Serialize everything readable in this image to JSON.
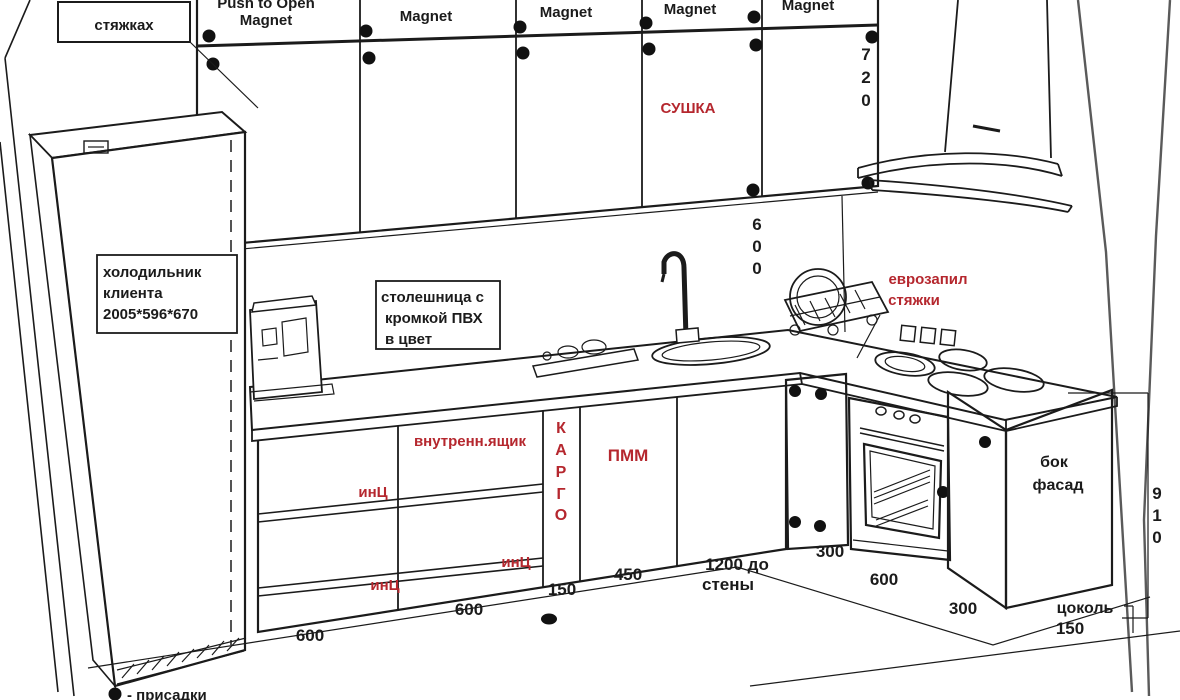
{
  "colors": {
    "ink": "#1b1b1b",
    "red": "#b5272e",
    "background": "#ffffff"
  },
  "wall_cabinets": {
    "doors": [
      {
        "top": "Push to Open",
        "label": "Magnet"
      },
      {
        "label": "Magnet"
      },
      {
        "label": "Magnet"
      },
      {
        "label": "Magnet"
      },
      {
        "label": "Magnet"
      }
    ],
    "dryer_label": "СУШКА",
    "height_digits": [
      "7",
      "2",
      "0"
    ]
  },
  "notes": {
    "ties": "стяжках",
    "fridge": {
      "lines": [
        "холодильник",
        "клиента",
        "2005*596*670"
      ]
    },
    "countertop": {
      "lines": [
        "столешница с",
        "кромкой ПВХ",
        "в цвет"
      ]
    },
    "euro_cut": {
      "lines": [
        "еврозапил",
        "стяжки"
      ]
    },
    "side_facade": {
      "lines": [
        "бок",
        "фасад"
      ]
    },
    "legend_text": "- присадки"
  },
  "base_cabinets": {
    "inner_drawer": "внутренн.ящик",
    "cargo_chars": [
      "К",
      "А",
      "Р",
      "Г",
      "О"
    ],
    "dishwasher": "ПММ",
    "hinge_a": "инЦ",
    "hinge_b": "инЦ",
    "hinge_c": "инЦ"
  },
  "dimensions": {
    "wall_gap_digits": [
      "6",
      "0",
      "0"
    ],
    "base_height_digits": [
      "9",
      "1",
      "0"
    ],
    "w600_left": "600",
    "w600_mid": "600",
    "w150_cargo": "150",
    "w450_pmm": "450",
    "to_wall": {
      "lines": [
        "1200 до",
        "стены"
      ]
    },
    "r300_a": "300",
    "r600_oven": "600",
    "r300_b": "300",
    "plinth_label": "цоколь",
    "plinth_value": "150"
  }
}
